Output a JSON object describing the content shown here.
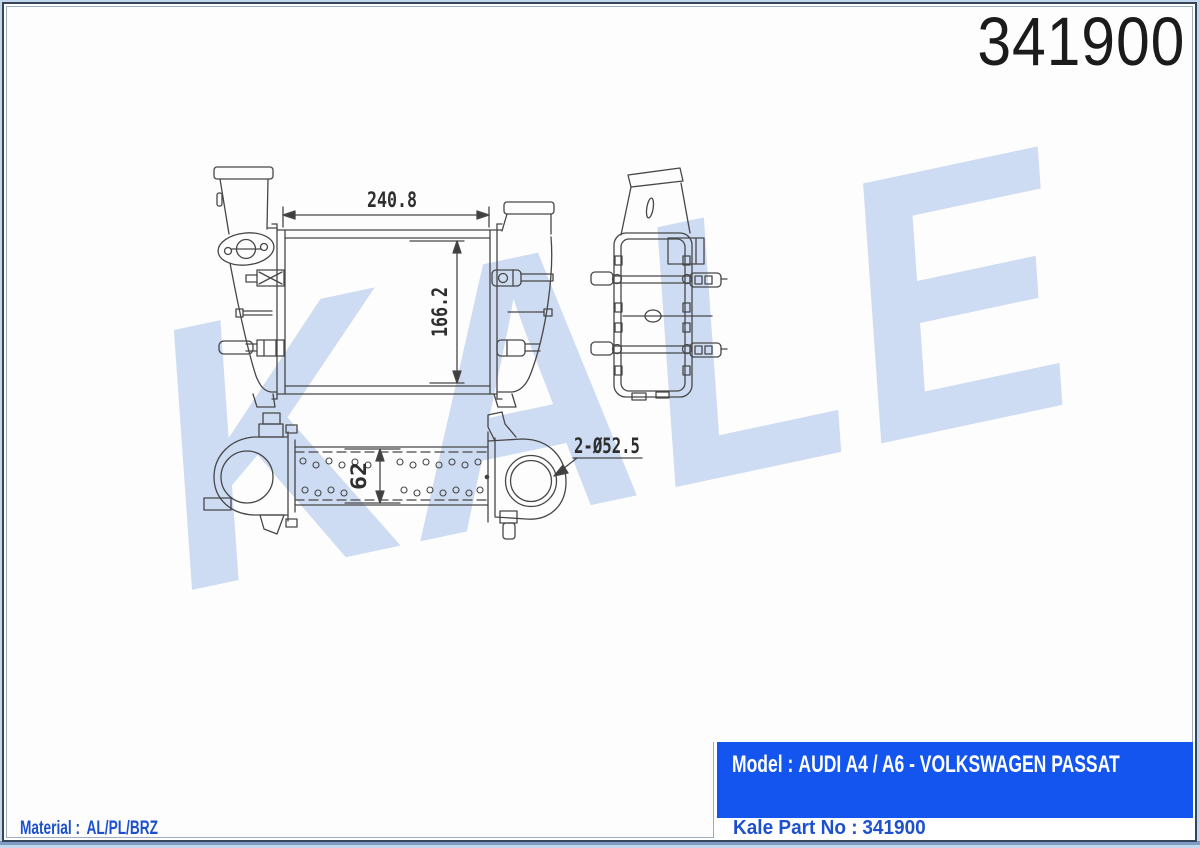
{
  "header": {
    "part_number": "341900"
  },
  "watermark": {
    "text": "KALE",
    "color": "#cddcf2"
  },
  "drawing": {
    "dim_width": "240.8",
    "dim_height": "166.2",
    "dim_depth": "62",
    "dim_ports": "2-Ø52.5",
    "line_color": "#474747"
  },
  "info_table": {
    "model_label": "Model :",
    "model_value": "AUDI A4 / A6 - VOLKSWAGEN PASSAT",
    "part_no_label": "Kale Part No :",
    "part_no_value": "341900",
    "box_blue": "#1355ee",
    "text_blue": "#1c50cc"
  },
  "material": {
    "label": "Material :",
    "value": "AL/PL/BRZ"
  }
}
